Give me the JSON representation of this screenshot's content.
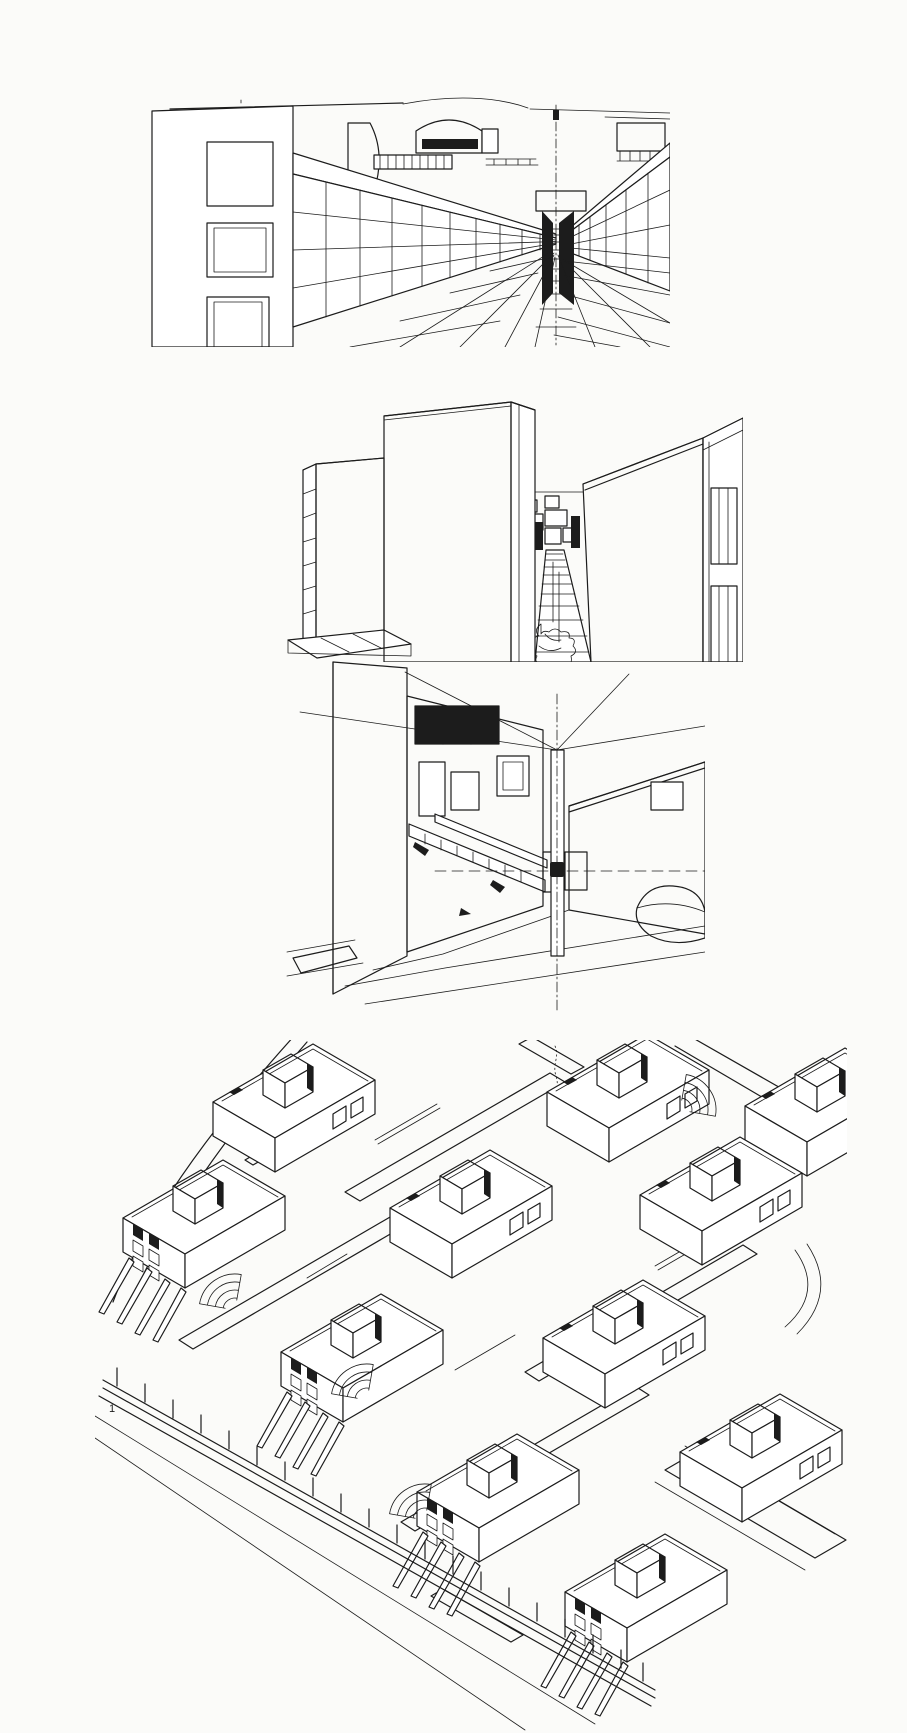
{
  "page": {
    "background": "#fbfbf9",
    "ink": "#1c1c1c"
  },
  "panels": [
    {
      "id": "street-perspective",
      "alt": "Ink one-point perspective of a walled street: gridded facade at left, stone block walls receding to a stepped passage, barrel-vaulted roofs, large paving slabs in foreground"
    },
    {
      "id": "alley-perspective",
      "alt": "Ink perspective of a narrow paved alley between large stone-block towers, plants at the path foot, louvered windows on the right wall"
    },
    {
      "id": "courtyard-corner",
      "alt": "Ink two-point perspective of a courtyard corner: brick walls with grille windows, a diagonal stair, a framed window, and a stippled sand mound"
    },
    {
      "id": "settlement-axonometric",
      "alt": "Ink axonometric of a hillside settlement: flat-roofed houses with rooftop stair boxes, hatched stair ramps, houses on angled struts, a long post fence and a curved road"
    }
  ],
  "panel4": {
    "mark": "1"
  }
}
